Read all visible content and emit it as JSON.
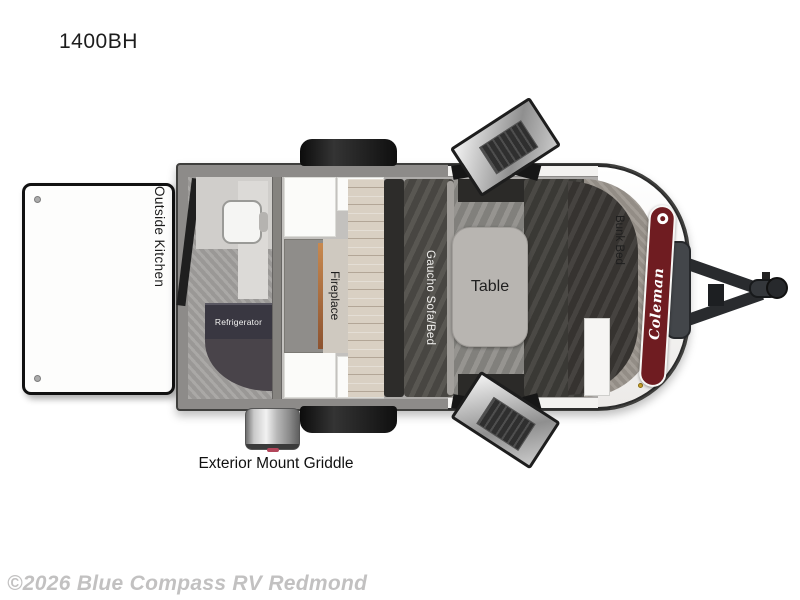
{
  "title": "1400BH",
  "watermark": "©2026 Blue Compass RV Redmond",
  "floorplan": {
    "exterior": {
      "outside_kitchen": "Outside Kitchen",
      "griddle": "Exterior Mount Griddle",
      "brand": "Coleman"
    },
    "interior": {
      "refrigerator": "Refrigerator",
      "fireplace": "Fireplace",
      "sofa": "Gaucho Sofa/Bed",
      "table": "Table",
      "bunk": "Bunk Bed"
    }
  },
  "colors": {
    "wall": "#8d8b89",
    "wood": "#d9d0c3",
    "sofa": "#504e49",
    "bench": "#413f3b",
    "table": "#b8b5b1",
    "bunk_pad": "#9c968e",
    "mattress": "#3c3936",
    "fridge": "#393741",
    "cabinet": "#fbfbf9",
    "coleman_red": "#6f1c21",
    "copper": "#b5724a",
    "watermark_gray": "#c2c1c1"
  }
}
